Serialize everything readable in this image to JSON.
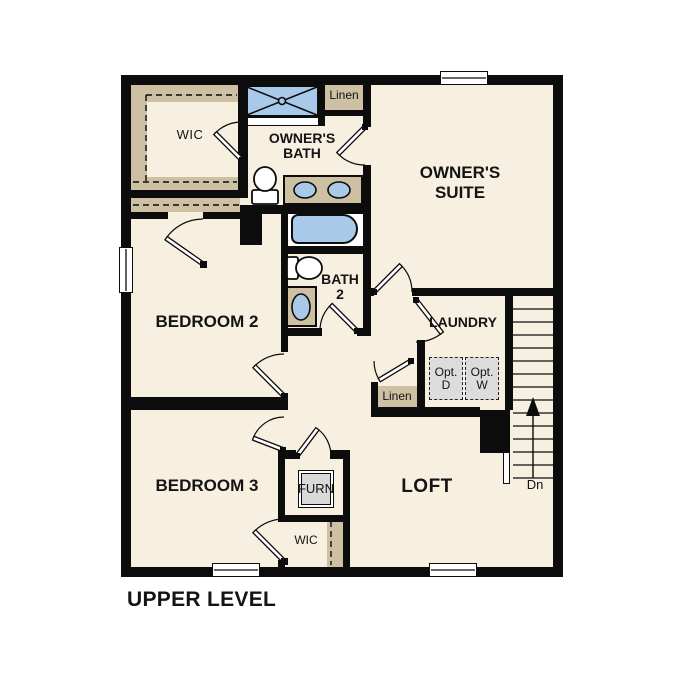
{
  "title": "UPPER LEVEL",
  "colors": {
    "wall": "#0c0c0c",
    "floor": "#f7efe0",
    "tan": "#cdc0a3",
    "blue": "#a9c9e9",
    "gray": "#dcdcdc",
    "paper": "#ffffff",
    "ink": "#141414"
  },
  "rooms": {
    "wic_top": {
      "label": "WIC"
    },
    "owners_bath": {
      "line1": "OWNER'S",
      "line2": "BATH"
    },
    "linen_top": {
      "label": "Linen"
    },
    "owners_suite": {
      "line1": "OWNER'S",
      "line2": "SUITE"
    },
    "bedroom2": {
      "label": "BEDROOM 2"
    },
    "bath2": {
      "line1": "BATH",
      "line2": "2"
    },
    "laundry": {
      "label": "LAUNDRY"
    },
    "opt_dryer": {
      "line1": "Opt.",
      "line2": "D"
    },
    "opt_washer": {
      "line1": "Opt.",
      "line2": "W"
    },
    "linen_bottom": {
      "label": "Linen"
    },
    "bedroom3": {
      "label": "BEDROOM 3"
    },
    "furnace_closet": {
      "label": "FURN"
    },
    "loft": {
      "label": "LOFT"
    },
    "wic_bottom": {
      "label": "WIC"
    },
    "stairs": {
      "direction_label": "Dn"
    }
  }
}
